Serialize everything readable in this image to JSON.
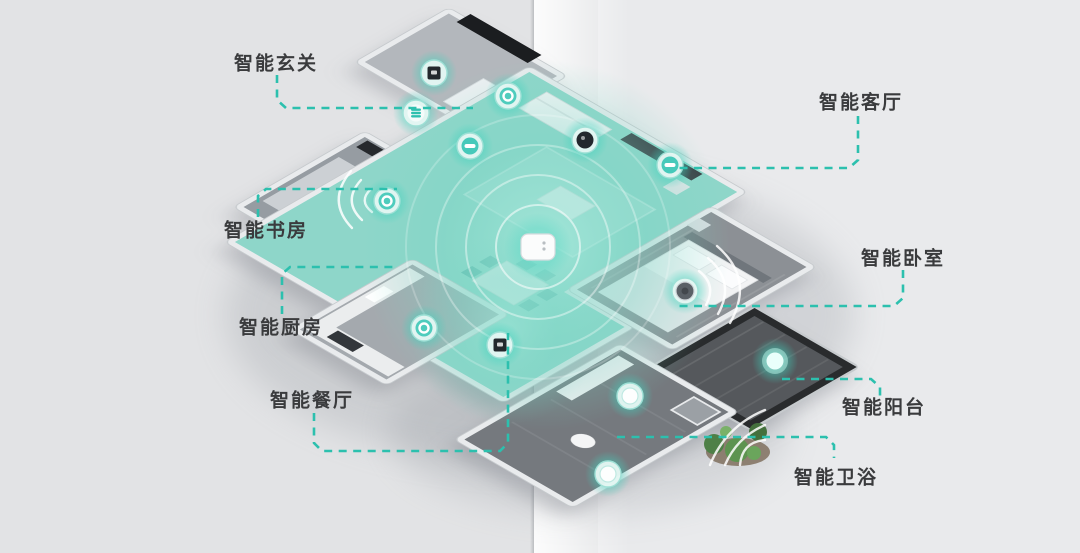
{
  "page": {
    "background_left": "#e2e3e5",
    "background_right": "#e9eaec",
    "fold_highlight": "#ffffff",
    "accent_teal": "#2cc0ae",
    "glow_teal": "#7fd6c8",
    "label_color": "#3a3b3d"
  },
  "diagram": {
    "type": "isometric-smart-home-floorplan",
    "labels": [
      {
        "id": "entry",
        "text": "智能玄关"
      },
      {
        "id": "living",
        "text": "智能客厅"
      },
      {
        "id": "study",
        "text": "智能书房"
      },
      {
        "id": "kitchen",
        "text": "智能厨房"
      },
      {
        "id": "dining",
        "text": "智能餐厅"
      },
      {
        "id": "bedroom",
        "text": "智能卧室"
      },
      {
        "id": "balcony",
        "text": "智能阳台"
      },
      {
        "id": "bathroom",
        "text": "智能卫浴"
      }
    ],
    "devices": [
      {
        "name": "entry-wall-panel-device",
        "icon": "dark-square-icon",
        "x": 434,
        "y": 73,
        "variant": "dark-square"
      },
      {
        "name": "living-ceiling-light-device",
        "icon": "ring-icon",
        "x": 508,
        "y": 96,
        "variant": "ring"
      },
      {
        "name": "fresh-air-system-device",
        "icon": "vent-bars-icon",
        "x": 416,
        "y": 113,
        "variant": "bars"
      },
      {
        "name": "smart-speaker-device",
        "icon": "white-bar-icon",
        "x": 470,
        "y": 146,
        "variant": "white-bar"
      },
      {
        "name": "security-camera-device",
        "icon": "dark-blob-icon",
        "x": 585,
        "y": 140,
        "variant": "dark-blob"
      },
      {
        "name": "curtain-controller-device",
        "icon": "white-bar-icon",
        "x": 670,
        "y": 165,
        "variant": "white-bar"
      },
      {
        "name": "study-sensor-device",
        "icon": "ring-icon",
        "x": 387,
        "y": 201,
        "variant": "ring"
      },
      {
        "name": "kitchen-sensor-device",
        "icon": "ring-icon",
        "x": 424,
        "y": 328,
        "variant": "ring"
      },
      {
        "name": "dining-wall-panel-device",
        "icon": "dark-square-icon",
        "x": 500,
        "y": 345,
        "variant": "dark-square"
      },
      {
        "name": "bedroom-sensor-device",
        "icon": "dark-circle-icon",
        "x": 685,
        "y": 291,
        "variant": "dark-circle"
      },
      {
        "name": "bathroom-sensor-device",
        "icon": "white-dot-icon",
        "x": 630,
        "y": 396,
        "variant": "white-dot"
      },
      {
        "name": "bathroom-light-device",
        "icon": "white-dot-icon",
        "x": 608,
        "y": 474,
        "variant": "white-dot"
      },
      {
        "name": "balcony-light-device",
        "icon": "glow-ball-icon",
        "x": 775,
        "y": 361,
        "variant": "glow-ball"
      }
    ],
    "hub": {
      "name": "smart-home-hub-device",
      "x": 538,
      "y": 247
    }
  }
}
